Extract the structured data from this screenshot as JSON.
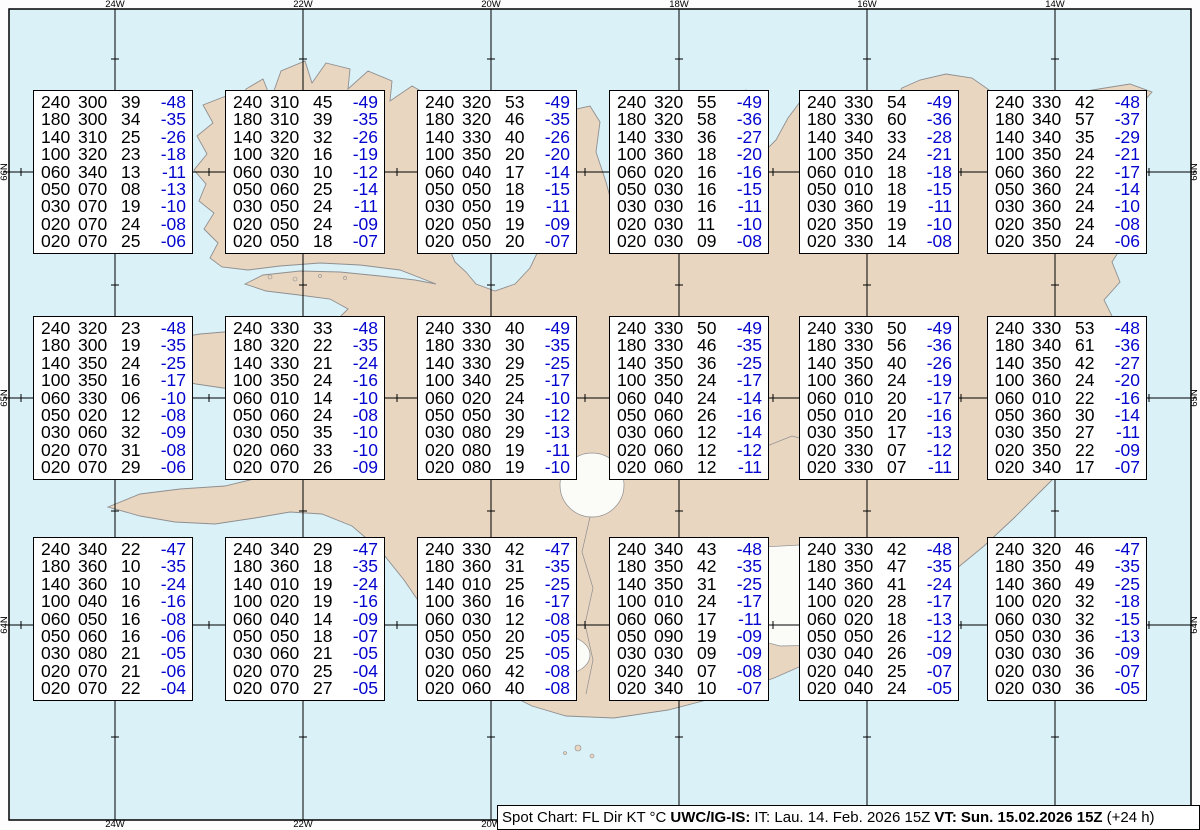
{
  "caption": {
    "product": "Spot Chart: FL Dir KT °C",
    "center": "UWC/IG-IS:",
    "issued": "IT: Lau. 14. Feb. 2026 15Z",
    "valid_label": "VT:",
    "valid_value": "Sun. 15.02.2026 15Z",
    "suffix": "(+24 h)"
  },
  "columns": [
    "FL",
    "Dir",
    "KT",
    "°C"
  ],
  "axes": {
    "top": [
      "24W",
      "22W",
      "20W",
      "18W",
      "16W",
      "14W"
    ],
    "bottom": [
      "24W",
      "22W",
      "20W"
    ],
    "left": [
      "66N",
      "65N",
      "64N"
    ],
    "right": [
      "66N",
      "65N",
      "64N"
    ]
  },
  "colors": {
    "temperature_text": "#0404cf",
    "value_text": "#000000",
    "land": "#e9d6c1",
    "ocean": "#daf1f8",
    "glacier": "#fbfbf8",
    "coastline": "#8f8f8f",
    "box_background": "#ffffff"
  },
  "stations": [
    {
      "rows": [
        [
          "240",
          "300",
          "39",
          "-48"
        ],
        [
          "180",
          "300",
          "34",
          "-35"
        ],
        [
          "140",
          "310",
          "25",
          "-26"
        ],
        [
          "100",
          "320",
          "23",
          "-18"
        ],
        [
          "060",
          "340",
          "13",
          "-11"
        ],
        [
          "050",
          "070",
          "08",
          "-13"
        ],
        [
          "030",
          "070",
          "19",
          "-10"
        ],
        [
          "020",
          "070",
          "24",
          "-08"
        ],
        [
          "020",
          "070",
          "25",
          "-06"
        ]
      ]
    },
    {
      "rows": [
        [
          "240",
          "310",
          "45",
          "-49"
        ],
        [
          "180",
          "310",
          "39",
          "-35"
        ],
        [
          "140",
          "320",
          "32",
          "-26"
        ],
        [
          "100",
          "320",
          "16",
          "-19"
        ],
        [
          "060",
          "030",
          "10",
          "-12"
        ],
        [
          "050",
          "060",
          "25",
          "-14"
        ],
        [
          "030",
          "050",
          "24",
          "-11"
        ],
        [
          "020",
          "050",
          "24",
          "-09"
        ],
        [
          "020",
          "050",
          "18",
          "-07"
        ]
      ]
    },
    {
      "rows": [
        [
          "240",
          "320",
          "53",
          "-49"
        ],
        [
          "180",
          "320",
          "46",
          "-35"
        ],
        [
          "140",
          "330",
          "40",
          "-26"
        ],
        [
          "100",
          "350",
          "20",
          "-20"
        ],
        [
          "060",
          "040",
          "17",
          "-14"
        ],
        [
          "050",
          "050",
          "18",
          "-15"
        ],
        [
          "030",
          "050",
          "19",
          "-11"
        ],
        [
          "020",
          "050",
          "19",
          "-09"
        ],
        [
          "020",
          "050",
          "20",
          "-07"
        ]
      ]
    },
    {
      "rows": [
        [
          "240",
          "320",
          "55",
          "-49"
        ],
        [
          "180",
          "320",
          "58",
          "-36"
        ],
        [
          "140",
          "330",
          "36",
          "-27"
        ],
        [
          "100",
          "360",
          "18",
          "-20"
        ],
        [
          "060",
          "020",
          "16",
          "-16"
        ],
        [
          "050",
          "030",
          "16",
          "-15"
        ],
        [
          "030",
          "030",
          "16",
          "-11"
        ],
        [
          "020",
          "030",
          "11",
          "-10"
        ],
        [
          "020",
          "030",
          "09",
          "-08"
        ]
      ]
    },
    {
      "rows": [
        [
          "240",
          "330",
          "54",
          "-49"
        ],
        [
          "180",
          "330",
          "60",
          "-36"
        ],
        [
          "140",
          "340",
          "33",
          "-28"
        ],
        [
          "100",
          "350",
          "24",
          "-21"
        ],
        [
          "060",
          "010",
          "18",
          "-18"
        ],
        [
          "050",
          "010",
          "18",
          "-15"
        ],
        [
          "030",
          "360",
          "19",
          "-11"
        ],
        [
          "020",
          "350",
          "19",
          "-10"
        ],
        [
          "020",
          "330",
          "14",
          "-08"
        ]
      ]
    },
    {
      "rows": [
        [
          "240",
          "330",
          "42",
          "-48"
        ],
        [
          "180",
          "340",
          "57",
          "-37"
        ],
        [
          "140",
          "340",
          "35",
          "-29"
        ],
        [
          "100",
          "350",
          "24",
          "-21"
        ],
        [
          "060",
          "360",
          "22",
          "-17"
        ],
        [
          "050",
          "360",
          "24",
          "-14"
        ],
        [
          "030",
          "360",
          "24",
          "-10"
        ],
        [
          "020",
          "350",
          "24",
          "-08"
        ],
        [
          "020",
          "350",
          "24",
          "-06"
        ]
      ]
    },
    {
      "rows": [
        [
          "240",
          "320",
          "23",
          "-48"
        ],
        [
          "180",
          "300",
          "19",
          "-35"
        ],
        [
          "140",
          "350",
          "24",
          "-25"
        ],
        [
          "100",
          "350",
          "16",
          "-17"
        ],
        [
          "060",
          "330",
          "06",
          "-10"
        ],
        [
          "050",
          "020",
          "12",
          "-08"
        ],
        [
          "030",
          "060",
          "32",
          "-09"
        ],
        [
          "020",
          "070",
          "31",
          "-08"
        ],
        [
          "020",
          "070",
          "29",
          "-06"
        ]
      ]
    },
    {
      "rows": [
        [
          "240",
          "330",
          "33",
          "-48"
        ],
        [
          "180",
          "320",
          "22",
          "-35"
        ],
        [
          "140",
          "330",
          "21",
          "-24"
        ],
        [
          "100",
          "350",
          "24",
          "-16"
        ],
        [
          "060",
          "010",
          "14",
          "-10"
        ],
        [
          "050",
          "060",
          "24",
          "-08"
        ],
        [
          "030",
          "050",
          "35",
          "-10"
        ],
        [
          "020",
          "060",
          "33",
          "-10"
        ],
        [
          "020",
          "070",
          "26",
          "-09"
        ]
      ]
    },
    {
      "rows": [
        [
          "240",
          "330",
          "40",
          "-49"
        ],
        [
          "180",
          "330",
          "30",
          "-35"
        ],
        [
          "140",
          "330",
          "29",
          "-25"
        ],
        [
          "100",
          "340",
          "25",
          "-17"
        ],
        [
          "060",
          "020",
          "24",
          "-10"
        ],
        [
          "050",
          "050",
          "30",
          "-12"
        ],
        [
          "030",
          "080",
          "29",
          "-13"
        ],
        [
          "020",
          "080",
          "19",
          "-11"
        ],
        [
          "020",
          "080",
          "19",
          "-10"
        ]
      ]
    },
    {
      "rows": [
        [
          "240",
          "330",
          "50",
          "-49"
        ],
        [
          "180",
          "330",
          "46",
          "-35"
        ],
        [
          "140",
          "350",
          "36",
          "-25"
        ],
        [
          "100",
          "350",
          "24",
          "-17"
        ],
        [
          "060",
          "040",
          "24",
          "-14"
        ],
        [
          "050",
          "060",
          "26",
          "-16"
        ],
        [
          "030",
          "060",
          "12",
          "-14"
        ],
        [
          "020",
          "060",
          "12",
          "-12"
        ],
        [
          "020",
          "060",
          "12",
          "-11"
        ]
      ]
    },
    {
      "rows": [
        [
          "240",
          "330",
          "50",
          "-49"
        ],
        [
          "180",
          "330",
          "56",
          "-36"
        ],
        [
          "140",
          "350",
          "40",
          "-26"
        ],
        [
          "100",
          "360",
          "24",
          "-19"
        ],
        [
          "060",
          "010",
          "20",
          "-17"
        ],
        [
          "050",
          "010",
          "20",
          "-16"
        ],
        [
          "030",
          "350",
          "17",
          "-13"
        ],
        [
          "020",
          "330",
          "07",
          "-12"
        ],
        [
          "020",
          "330",
          "07",
          "-11"
        ]
      ]
    },
    {
      "rows": [
        [
          "240",
          "330",
          "53",
          "-48"
        ],
        [
          "180",
          "340",
          "61",
          "-36"
        ],
        [
          "140",
          "350",
          "42",
          "-27"
        ],
        [
          "100",
          "360",
          "24",
          "-20"
        ],
        [
          "060",
          "010",
          "22",
          "-16"
        ],
        [
          "050",
          "360",
          "30",
          "-14"
        ],
        [
          "030",
          "350",
          "27",
          "-11"
        ],
        [
          "020",
          "350",
          "22",
          "-09"
        ],
        [
          "020",
          "340",
          "17",
          "-07"
        ]
      ]
    },
    {
      "rows": [
        [
          "240",
          "340",
          "22",
          "-47"
        ],
        [
          "180",
          "360",
          "10",
          "-35"
        ],
        [
          "140",
          "360",
          "10",
          "-24"
        ],
        [
          "100",
          "040",
          "16",
          "-16"
        ],
        [
          "060",
          "050",
          "16",
          "-08"
        ],
        [
          "050",
          "060",
          "16",
          "-06"
        ],
        [
          "030",
          "080",
          "21",
          "-05"
        ],
        [
          "020",
          "070",
          "21",
          "-06"
        ],
        [
          "020",
          "070",
          "22",
          "-04"
        ]
      ]
    },
    {
      "rows": [
        [
          "240",
          "340",
          "29",
          "-47"
        ],
        [
          "180",
          "360",
          "18",
          "-35"
        ],
        [
          "140",
          "010",
          "19",
          "-24"
        ],
        [
          "100",
          "020",
          "19",
          "-16"
        ],
        [
          "060",
          "040",
          "14",
          "-09"
        ],
        [
          "050",
          "050",
          "18",
          "-07"
        ],
        [
          "030",
          "060",
          "21",
          "-05"
        ],
        [
          "020",
          "070",
          "25",
          "-04"
        ],
        [
          "020",
          "070",
          "27",
          "-05"
        ]
      ]
    },
    {
      "rows": [
        [
          "240",
          "330",
          "42",
          "-47"
        ],
        [
          "180",
          "360",
          "31",
          "-35"
        ],
        [
          "140",
          "010",
          "25",
          "-25"
        ],
        [
          "100",
          "360",
          "16",
          "-17"
        ],
        [
          "060",
          "030",
          "12",
          "-08"
        ],
        [
          "050",
          "050",
          "20",
          "-05"
        ],
        [
          "030",
          "050",
          "25",
          "-05"
        ],
        [
          "020",
          "060",
          "42",
          "-08"
        ],
        [
          "020",
          "060",
          "40",
          "-08"
        ]
      ]
    },
    {
      "rows": [
        [
          "240",
          "340",
          "43",
          "-48"
        ],
        [
          "180",
          "350",
          "42",
          "-35"
        ],
        [
          "140",
          "350",
          "31",
          "-25"
        ],
        [
          "100",
          "010",
          "24",
          "-17"
        ],
        [
          "060",
          "060",
          "17",
          "-11"
        ],
        [
          "050",
          "090",
          "19",
          "-09"
        ],
        [
          "030",
          "030",
          "09",
          "-09"
        ],
        [
          "020",
          "340",
          "07",
          "-08"
        ],
        [
          "020",
          "340",
          "10",
          "-07"
        ]
      ]
    },
    {
      "rows": [
        [
          "240",
          "330",
          "42",
          "-48"
        ],
        [
          "180",
          "350",
          "47",
          "-35"
        ],
        [
          "140",
          "360",
          "41",
          "-24"
        ],
        [
          "100",
          "020",
          "28",
          "-17"
        ],
        [
          "060",
          "020",
          "18",
          "-13"
        ],
        [
          "050",
          "050",
          "26",
          "-12"
        ],
        [
          "030",
          "040",
          "26",
          "-09"
        ],
        [
          "020",
          "040",
          "25",
          "-07"
        ],
        [
          "020",
          "040",
          "24",
          "-05"
        ]
      ]
    },
    {
      "rows": [
        [
          "240",
          "320",
          "46",
          "-47"
        ],
        [
          "180",
          "350",
          "49",
          "-35"
        ],
        [
          "140",
          "360",
          "49",
          "-25"
        ],
        [
          "100",
          "020",
          "32",
          "-18"
        ],
        [
          "060",
          "030",
          "32",
          "-15"
        ],
        [
          "050",
          "030",
          "36",
          "-13"
        ],
        [
          "030",
          "030",
          "36",
          "-09"
        ],
        [
          "020",
          "030",
          "36",
          "-07"
        ],
        [
          "020",
          "030",
          "36",
          "-05"
        ]
      ]
    }
  ]
}
